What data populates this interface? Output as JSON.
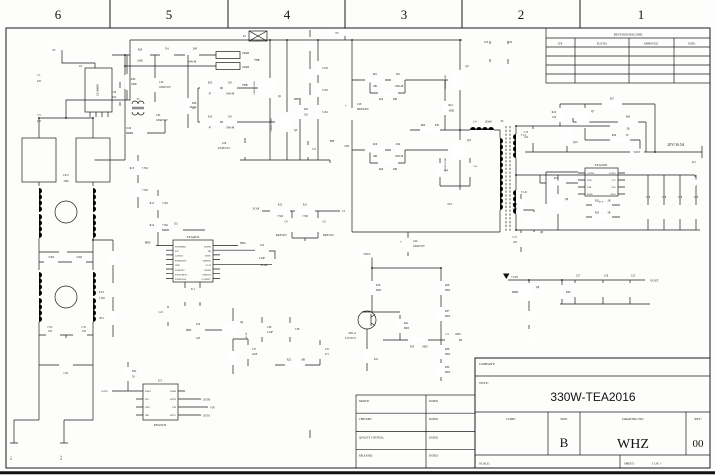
{
  "frame": {
    "zones": [
      "6",
      "5",
      "4",
      "3",
      "2",
      "1"
    ]
  },
  "revision": {
    "title": "REVISION RECORD",
    "col_ltr": "LTR",
    "col_eco": "ECO NO:",
    "col_approved": "APPROVED:",
    "col_date": "DATE:"
  },
  "approval": {
    "rows": [
      "DRAWN:",
      "CHECKED:",
      "QUALITY CONTROL:",
      "RELEASED:"
    ],
    "dated": "DATED:"
  },
  "titleblock": {
    "company": "COMPANY:",
    "title_label": "TITLE:",
    "title": "330W-TEA2016",
    "code": "CODE:",
    "size_label": "SIZE:",
    "size": "B",
    "drawing_label": "DRAWING NO:",
    "drawing": "WHZ",
    "rev_label": "REV:",
    "rev": "00",
    "scale": "SCALE:",
    "sheet_label": "SHEET:",
    "sheet": "1 OF 1"
  },
  "schematic": {
    "u1": {
      "ref": "U1",
      "part": "TEA2016",
      "pins_left": [
        "SNSTIMER",
        "SCL",
        "GATELS",
        "SNSBOOST",
        "GND",
        "SGNDPFC",
        "SNSCURPFC",
        "SNSMAINS"
      ],
      "pins_right": [
        "SUPHS",
        "HB",
        "SUPIC",
        "SUPREG",
        "SCAP",
        "SNSFB",
        "SNSOUT",
        "GATEPFC"
      ]
    },
    "u2": {
      "ref": "U2",
      "part": "LSC6060N"
    },
    "u3": {
      "ref": "U3",
      "part": "TEA1995",
      "pins_left": [
        "GATEB",
        "GND",
        "DSB",
        "SNSB"
      ],
      "pins_right": [
        "GATEA",
        "VCC",
        "DSA",
        "SNSA"
      ]
    },
    "u5": {
      "ref": "U5",
      "part": "P3610CN",
      "pins_left": [
        "ENBA",
        "INA",
        "GND",
        "INB"
      ],
      "pins_right": [
        "ENBB",
        "OUTB",
        "VIN",
        "OUTA"
      ]
    },
    "u6": {
      "ref": "U6"
    },
    "labels": {
      "v8": "8V",
      "v9": "9V",
      "v12": "+12V",
      "plus": "+",
      "c1": "C1",
      "c1v": "225",
      "c3": "C3",
      "c3v": "225",
      "r29": "R29",
      "r29v": "100K",
      "d4": "D4",
      "d45": "D45",
      "d45v": "1N4148",
      "r30": "R30",
      "r30v": "180K",
      "c30": "C30",
      "c30v": "100uF/25V",
      "c26": "C26",
      "c26v": "104",
      "t3": "T3",
      "c34": "C34",
      "c34v": "100uF/25V",
      "r36": "R36",
      "r36v": "1K",
      "d16": "D16",
      "k1": "K1",
      "l2v": "100uH",
      "l3v": "100uH",
      "fbb": "FBB",
      "q1": "Q1",
      "q1p": "CE6941100ND",
      "q5": "Q5",
      "q5p": "CE6941100ND",
      "r23": "R23",
      "r23v": "47",
      "d9": "D9",
      "d9v": "1N4148",
      "outa": "OUTA",
      "r10": "R10",
      "r10v": "47",
      "d8": "D8",
      "d8v": "1N4148",
      "dpfc": "DPFC",
      "r51": "R51",
      "r51v": "1M",
      "m51": "5.1M",
      "m52": "5.1M",
      "m53": "5.1M",
      "c29": "C29",
      "c29v": "470pF/1KV",
      "c11": "C11",
      "fbp": "FBP",
      "lf2": "LF2",
      "lf2v": "25M",
      "lf1": "LF1",
      "lf1v": "1.5M",
      "r3a": "3.3M",
      "r3b": "3.3M",
      "cy2": "CY2",
      "cy2v": "102",
      "cy1": "CY1",
      "cy1v": "102",
      "cx1": "CX1",
      "rt1": "RT1",
      "j11": "J1-1",
      "j12": "J1-2",
      "r13": "R13",
      "r13v": "7.5M",
      "r14": "R14",
      "r14v": "7.5M",
      "r15": "R15",
      "r15v": "7.5M",
      "r15b": "7.5M",
      "d2": "D2",
      "bpfc": "BPFC",
      "hbg": "HBG",
      "c22": "C22",
      "c22v": "2.2nF",
      "scap": "SCAP",
      "scap2": "SCAP",
      "r12": "R12",
      "r12v": "7.5M",
      "r11": "R11",
      "r11v": "7.5M",
      "c9": "C9",
      "c9v": "68pF/1KV",
      "c8": "C8",
      "c8v": "68pF/1KV",
      "c5": "C5",
      "c23": "C23",
      "c32": "C32",
      "r21": "R21",
      "r21v": "10K",
      "d11": "D11",
      "d11v": "1N4148",
      "r24": "R24",
      "r24v": "20R",
      "q3": "Q3",
      "q3p": "CE65H1100ND",
      "r61": "R61",
      "r61v": "100K",
      "r60": "R60",
      "r60v": "47R",
      "l4": "L4",
      "l4v": "100uH",
      "c28": "C28",
      "c28v": "68uF/450V",
      "lbc": "LBC",
      "r19": "R19",
      "r19v": "10R",
      "d14": "D14",
      "d14v": "1N4148",
      "r49": "R49",
      "r49v": "20R",
      "q11": "Q11",
      "q11p": "CE65H1100ND",
      "r62v": "100R",
      "c12v": "224",
      "oc1": "OC1",
      "t1": "T1",
      "t1c": "T1-C",
      "t1d": "T1-D",
      "r27": "R27",
      "r16": "R16",
      "r16v": "100",
      "c13": "C13",
      "c13v": "222",
      "q7": "Q7",
      "q10": "Q10",
      "r42": "R42",
      "r42v": "2R",
      "r34": "R34",
      "r34v": "50",
      "vout": "VOUT",
      "spec": "20V/16.5A",
      "j21": "J2-1",
      "r17": "R17",
      "q6": "Q6",
      "q8": "Q8",
      "r50": "R50",
      "r50v": "50R",
      "c17": "C17",
      "c17v": "222",
      "r32": "R32",
      "r32v": "2R",
      "r33": "R33",
      "r33v": "2R",
      "c16": "C16",
      "c18": "C18",
      "c19": "C19",
      "c20": "C20",
      "c27": "C27",
      "c26s": "C26",
      "c25": "C25",
      "q9": "Q9",
      "r40": "R40",
      "c40": "C40",
      "c40v": "100uF/25V",
      "r18": "R18",
      "r28": "R28",
      "r37": "R37",
      "r41": "R41",
      "r35": "R35",
      "c4": "C4",
      "r38": "R38",
      "r39": "R39",
      "sz": "0603",
      "op1a": "OP1-A",
      "op1ap": "LTV-817S",
      "gatep": "GATEP",
      "r52": "R52",
      "r52v": "50",
      "outb": "OUTB",
      "vin": "VIN",
      "outan": "OUTA",
      "q4": "Q4",
      "op1b": "OP1-B",
      "c24": "C24",
      "c24v": "1uF",
      "c37": "C37",
      "c37v": "22nF",
      "c21": "C21",
      "c36": "C36",
      "c36v": "2.2uF",
      "c38": "C38",
      "r22": "R22",
      "r22v": "10R",
      "c31": "C31",
      "c31v": "471"
    }
  }
}
